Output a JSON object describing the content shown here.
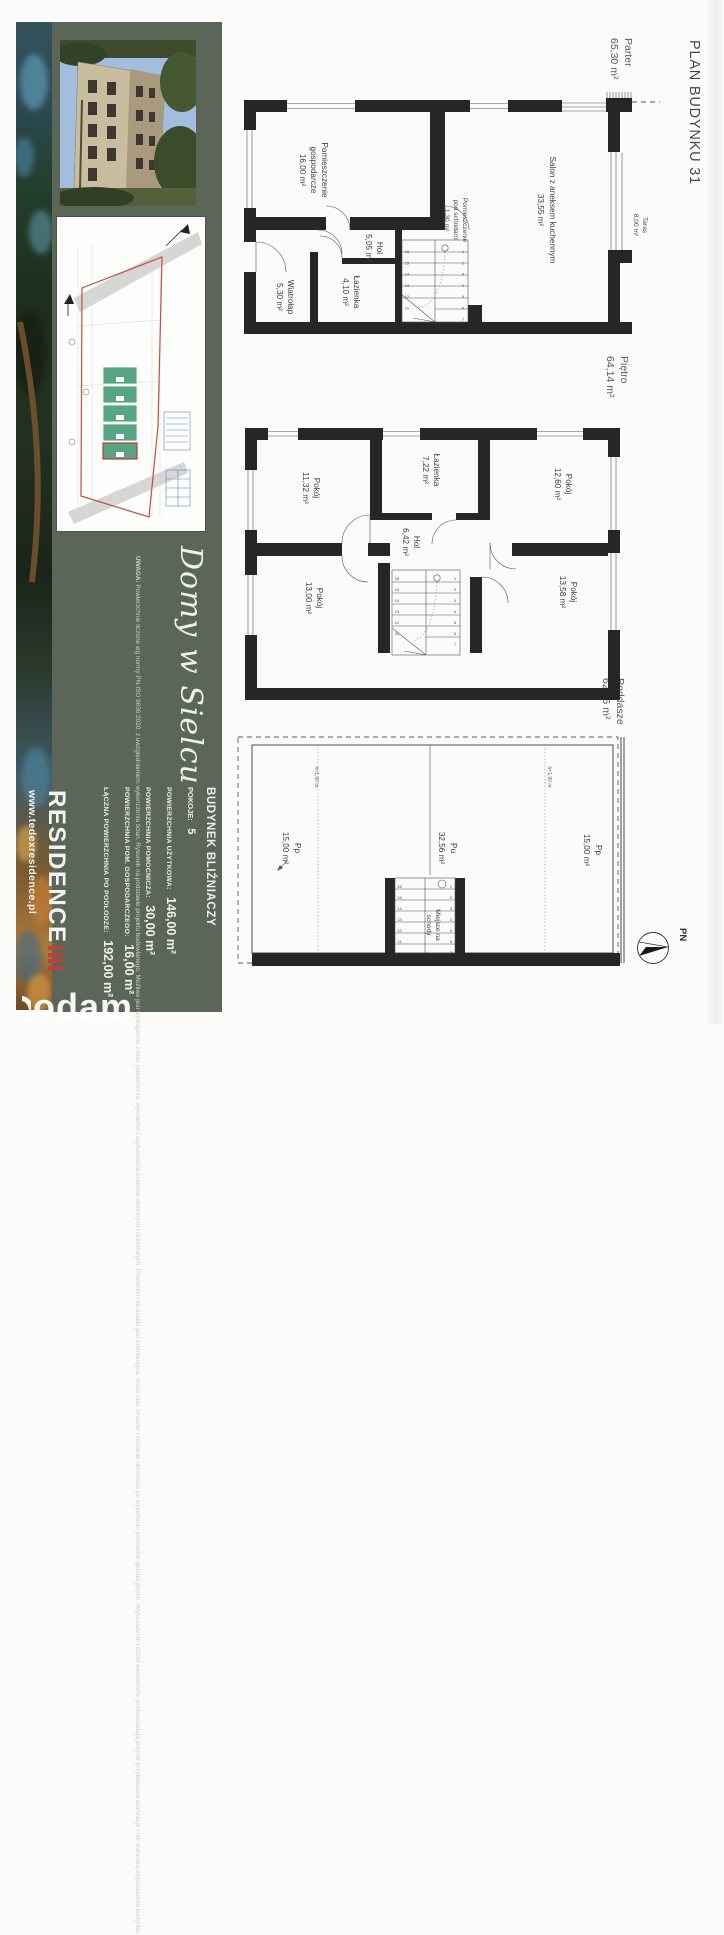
{
  "document": {
    "title": "PLAN BUDYNKU 31",
    "compass": "PN",
    "watermark": "odam"
  },
  "sidebar": {
    "website": "www.tedexresidence.pl",
    "logo": "RESIDENCE",
    "tagline": "Domy w Sielcu",
    "note": {
      "title": "UWAGA:",
      "body": "Powierzchnie liczone wg normy PN-ISO 9836:2020, z uwzględnieniem wykończenia ścian. Rysunek na podstawie projektu budowlanego. Możliwe jest wystąpienie zmian powierzchni, wymiarów i usytuowania otworów okiennych i drzwiowych. Powierzchnia działki jest orientacyjna, może ulec zmianie i zostanie określona po wykonaniu pomiarów geodezyjnych. Wyposażenie i drzwi wewnętrzne przedstawiają jedynie przykładową aranżację i nie stanowią wyposażenia budynku."
    },
    "specs": {
      "building_type": "BUDYNEK BLIŹNIACZY",
      "rooms_label": "POKOJE:",
      "rooms_value": "5",
      "rows": [
        {
          "label": "POWIERZCHNIA UŻYTKOWA:",
          "value": "146,00 m²"
        },
        {
          "label": "POWIERZCHNIA POMOCNICZA:",
          "value": "30,00 m²"
        },
        {
          "label": "POWIERZCHNIA POM. GOSPODARCZEGO:",
          "value": "16,00 m²"
        },
        {
          "label": "ŁĄCZNA POWIERZCHNIA PO PODŁODZE:",
          "value": "192,00 m²"
        }
      ]
    }
  },
  "floors": [
    {
      "name": "Parter",
      "area": "65,30 m²",
      "rooms": {
        "gospodarcze": {
          "line1": "Pomieszczenie",
          "line2": "gospodarcze",
          "area": "16,00 m²"
        },
        "salon": {
          "line1": "Salon z aneksem kuchennym",
          "area": "33,55 m²"
        },
        "hol": {
          "line1": "Hol",
          "area": "5,05 m²"
        },
        "pod_schodami": {
          "line1": "Pomieszczenie",
          "line2": "pod schodami",
          "area": "1,30 m²"
        },
        "wiatrolap": {
          "line1": "Wiatrołap",
          "area": "5,30 m²"
        },
        "lazienka": {
          "line1": "Łazienka",
          "area": "4,10 m²"
        },
        "taras": {
          "line1": "Taras",
          "area": "8,00 m²"
        }
      },
      "stairs": {
        "left": [
          "16",
          "15",
          "14",
          "13",
          "12",
          "11"
        ],
        "right": [
          "1",
          "2",
          "3",
          "4",
          "5",
          "6",
          "7"
        ]
      }
    },
    {
      "name": "Piętro",
      "area": "64,14 m²",
      "rooms": {
        "pokoj1": {
          "line1": "Pokój",
          "area": "11,32 m²"
        },
        "lazienka": {
          "line1": "Łazienka",
          "area": "7,22 m²"
        },
        "pokoj2": {
          "line1": "Pokój",
          "area": "12,60 m²"
        },
        "hol": {
          "line1": "Hol",
          "area": "6,42 m²"
        },
        "pokoj3": {
          "line1": "Pokój",
          "area": "13,00 m²"
        },
        "pokoj4": {
          "line1": "Pokój",
          "area": "13,58 m²"
        }
      },
      "stairs": {
        "left": [
          "16",
          "15",
          "14",
          "13",
          "12",
          "11"
        ],
        "right": [
          "1",
          "2",
          "3",
          "4",
          "5",
          "6",
          "7"
        ]
      }
    },
    {
      "name": "Poddasze",
      "area": "62,56 m²",
      "height_note": "h=1,90 m",
      "rooms": {
        "pp_left": {
          "line1": "Pp",
          "area": "15,00 m²"
        },
        "pu": {
          "line1": "Pu",
          "area": "32,56 m²"
        },
        "pp_right": {
          "line1": "Pp",
          "area": "15,00 m²"
        },
        "schody": {
          "line1": "Miejsce na",
          "line2": "schody"
        }
      },
      "stairs": {
        "left": [
          "16",
          "15",
          "14",
          "13",
          "12",
          "11"
        ],
        "right": [
          "1",
          "2",
          "3",
          "4",
          "5",
          "6",
          "7"
        ]
      }
    }
  ]
}
